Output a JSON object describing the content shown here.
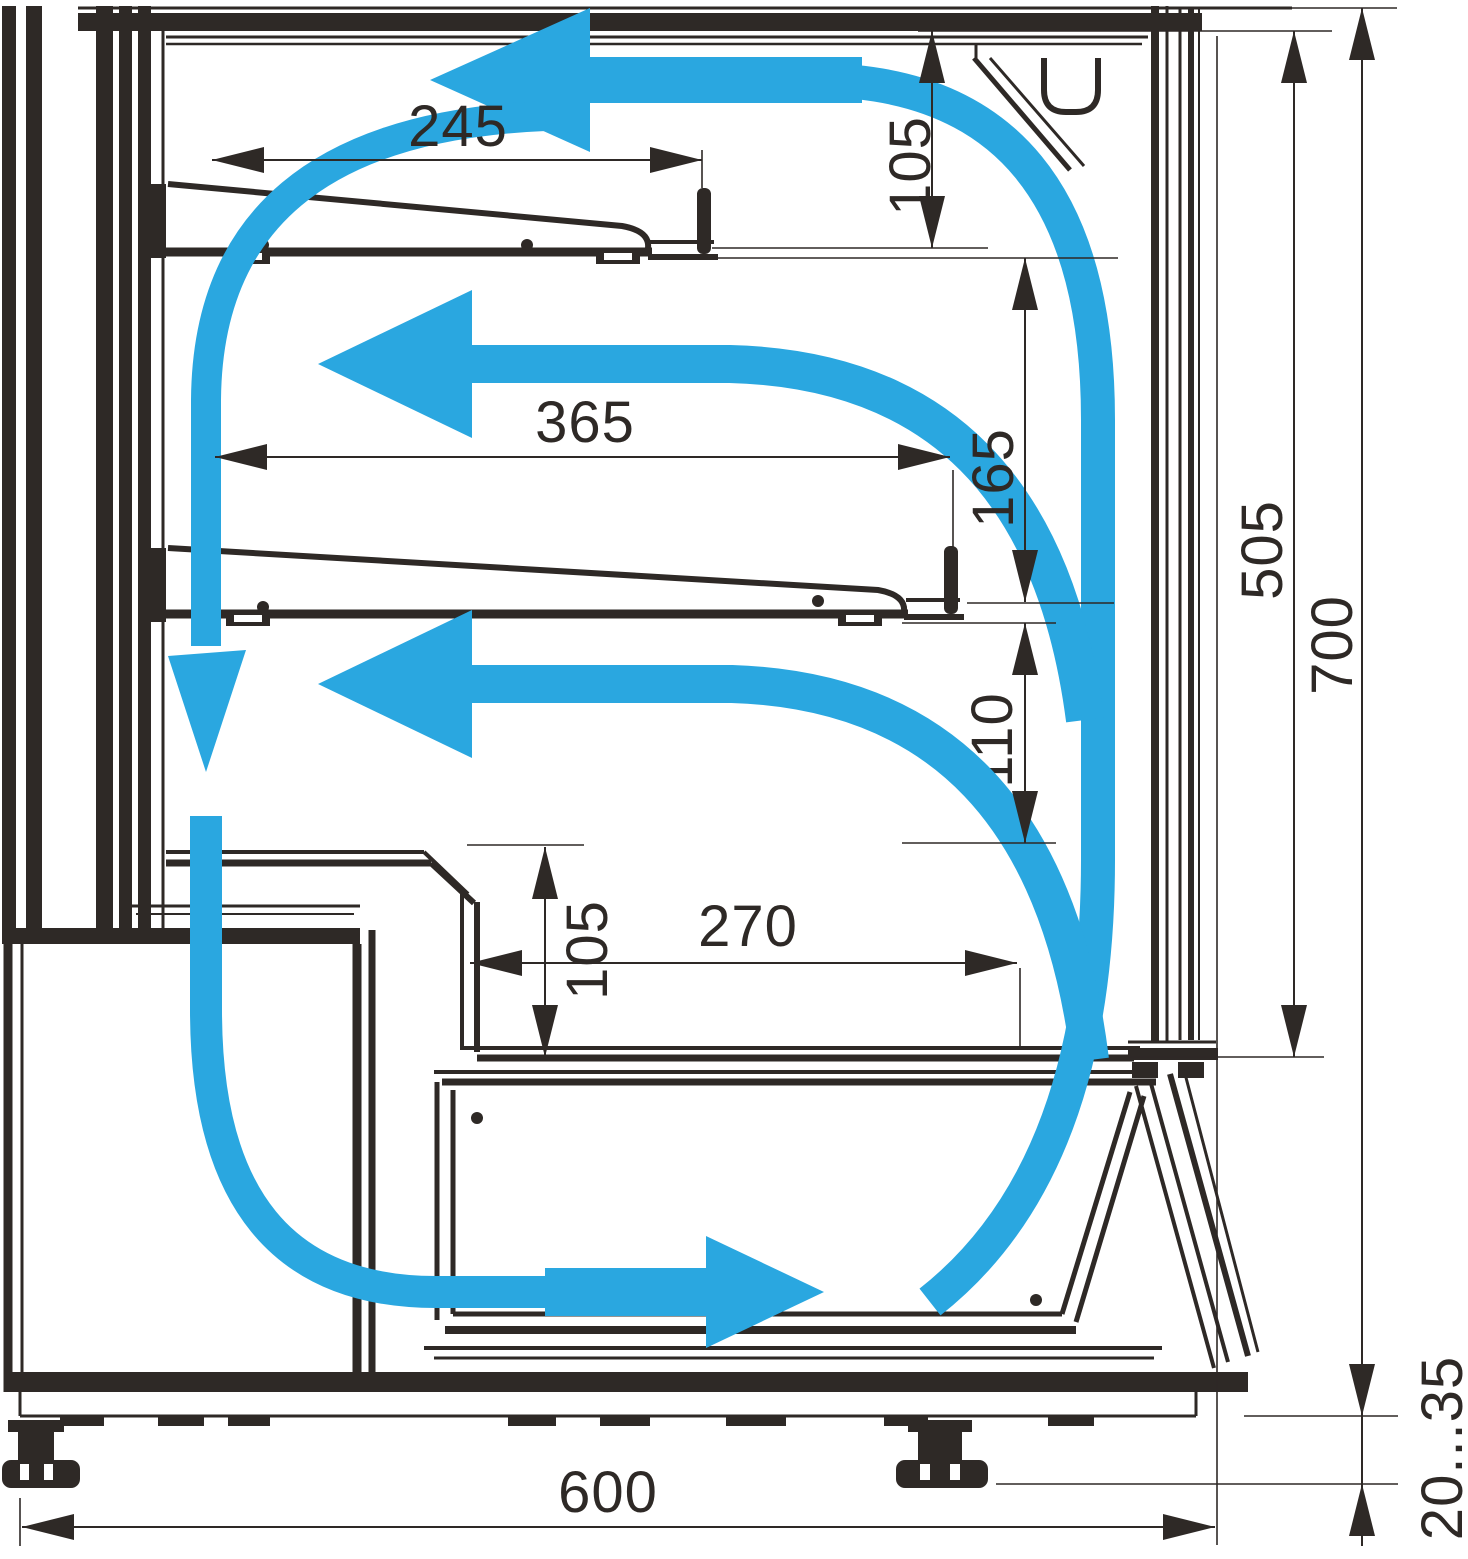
{
  "diagram": {
    "title": "Refrigerated display case cross-section with air circulation",
    "colors": {
      "airflow_blue": "#2aa7e0",
      "line_ink": "#2e2926"
    },
    "dimensions": {
      "upper_shelf_depth": "245",
      "top_clearance": "105",
      "middle_shelf_depth": "365",
      "middle_clearance": "165",
      "lower_clearance": "110",
      "well_depth": "270",
      "well_clearance": "105",
      "display_opening_height": "505",
      "overall_inner_height": "700",
      "overall_depth": "600",
      "foot_adjust_range": "20...35"
    }
  }
}
